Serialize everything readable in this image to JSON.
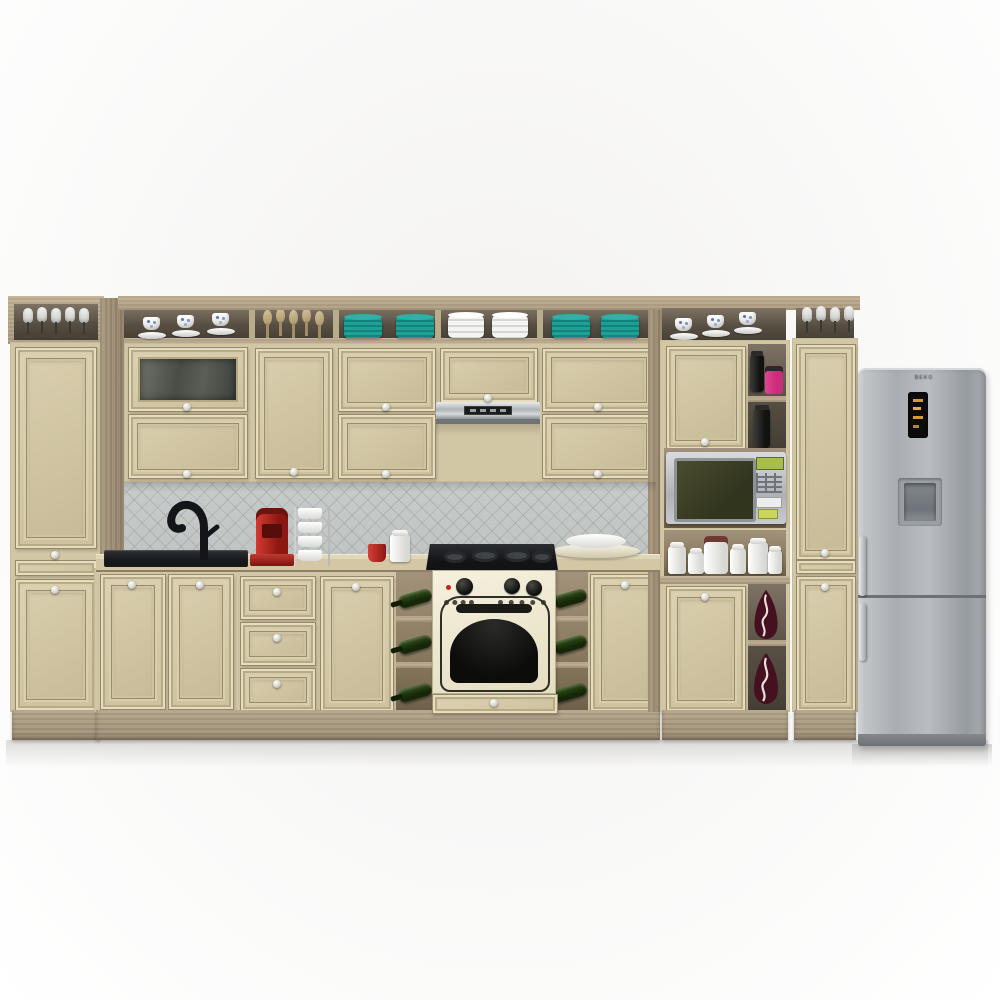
{
  "scene": {
    "type": "3d-product-render",
    "subject": "Classic cream kitchen cabinet set with wood carcass and appliances",
    "background": "white studio wall and floor"
  },
  "fridge": {
    "brand": "BEKO",
    "finish": "stainless steel",
    "visible_features": [
      "black digital display with amber segments",
      "recessed water dispenser",
      "two doors",
      "vertical bar handles"
    ]
  },
  "appliances": [
    "range hood",
    "gas cooktop",
    "retro cream built-in oven",
    "silver microwave",
    "refrigerator",
    "red single-serve coffee maker"
  ],
  "shelf_items": {
    "left_top_shelf": {
      "item": "wine glasses",
      "count": 5
    },
    "upper_open_shelf_sections": [
      {
        "item": "teacups with saucers",
        "count": 3
      },
      {
        "item": "wooden spoons",
        "count": 5
      },
      {
        "item": "teal plate stacks",
        "count": 2
      },
      {
        "item": "white bowl stacks",
        "count": 2
      },
      {
        "item": "teal plate stacks",
        "count": 2
      }
    ],
    "right_top_shelf": {
      "item": "teacups with saucers",
      "count": 3
    },
    "far_right_top_shelf": {
      "item": "wine glasses",
      "count": 4
    },
    "tall_unit_niches": [
      "black jar",
      "magenta canister",
      "black jar",
      "white canisters",
      "maroon vases with white pattern"
    ],
    "wine_racks": {
      "item": "green wine bottles",
      "cells_per_rack": 3,
      "racks": 2
    },
    "counter_items": [
      "black sink with black arched faucet",
      "red coffee maker",
      "cup stand with four white cups",
      "red mug",
      "white lidded jar",
      "stack of cream plates"
    ]
  },
  "palette": {
    "cream": "#d2c7a5",
    "wood": "#ab9a80",
    "woodLight": "#c2b296",
    "woodDark": "#93826b",
    "counter": "#d3c7a6",
    "tile": "#ccd0cf",
    "teal": "#1fa096",
    "magenta": "#cb2d7c",
    "maroon": "#451120",
    "bottleGreen": "#24400f",
    "applianceRed": "#ae211c",
    "steel": "#b0b4b8",
    "ovenCream": "#f1ebd5",
    "displayAmber": "#d79b2f",
    "microLime": "#a8bd4a",
    "black": "#17181a"
  }
}
